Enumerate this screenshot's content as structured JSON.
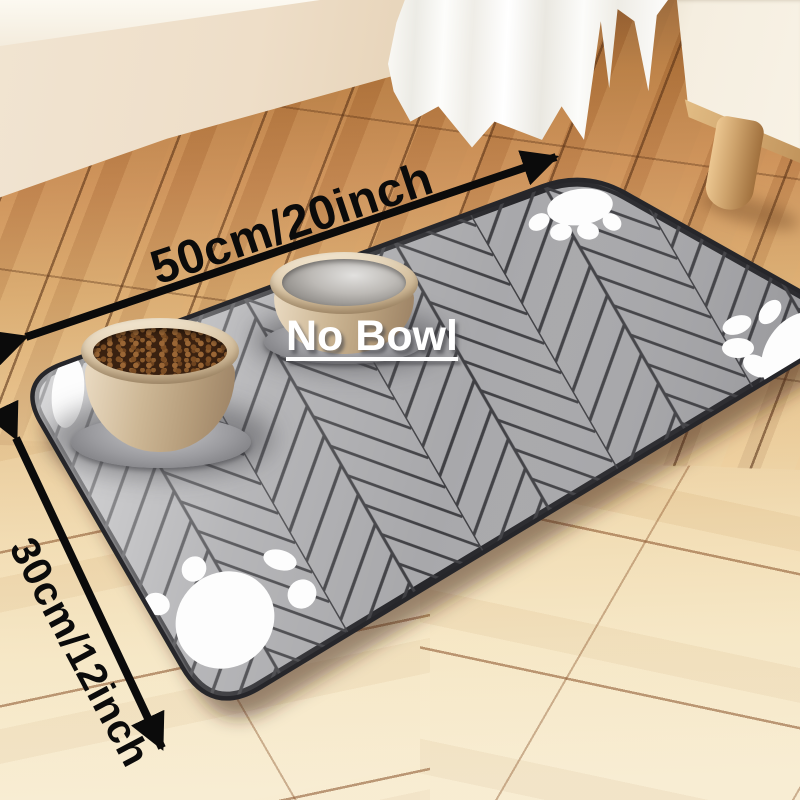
{
  "scene": {
    "type": "product photo",
    "subject": "gray herringbone pet feeding mat with two bowls on a wooden floor"
  },
  "labels": {
    "width_dimension": "50cm/20inch",
    "height_dimension": "30cm/12inch",
    "bowl_annotation": "No Bowl"
  },
  "icons": {
    "width_arrow": "double-headed-arrow-icon",
    "height_arrow": "double-headed-arrow-icon",
    "paw_prints": "paw-print-icon"
  },
  "colors": {
    "annotation_black": "#0b0b0b",
    "annotation_white": "#ffffff",
    "mat_gray": "#a8a8ab",
    "mat_seam": "#3f3f43",
    "mat_edge": "#26262a",
    "paw_white": "#fdfdfd",
    "floor_dark_wood": "#b5793f",
    "floor_light_wood": "#f5e6c4",
    "wall_cream": "#f1e4d1",
    "curtain_white": "#fbfaf6",
    "cabinet_cream": "#f5eee0",
    "leg_wood": "#cda26b",
    "bowl_beige": "#cdb795",
    "kibble_brown": "#7d4e24",
    "water_gray": "#bdbab6"
  }
}
